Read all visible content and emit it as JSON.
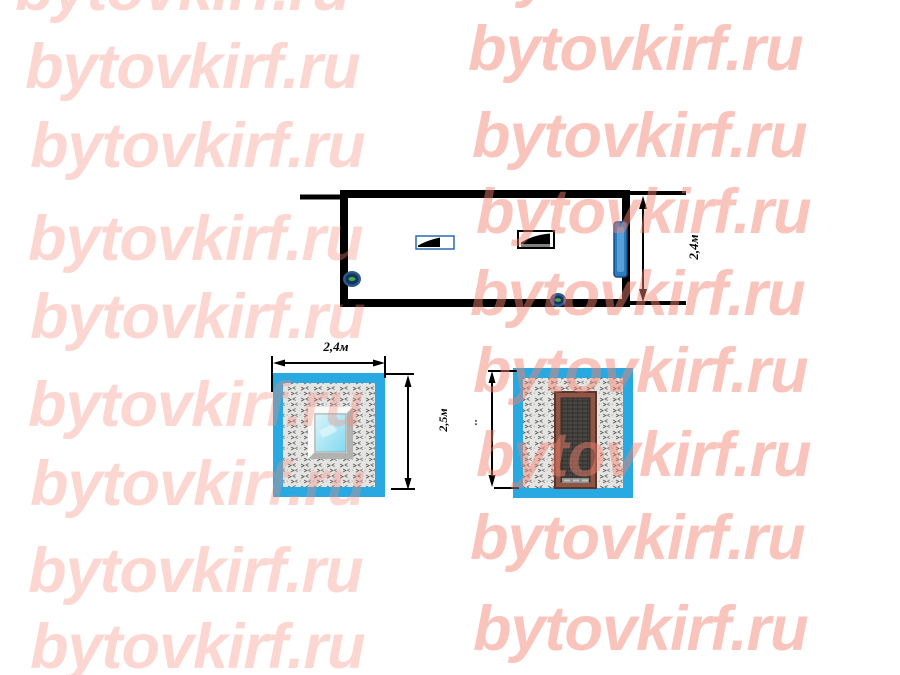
{
  "watermark": {
    "text": "bytovkirf.ru"
  },
  "drawing": {
    "plan": {
      "width_label": "2,4м"
    },
    "front_elevation": {
      "width_label": "2,4м",
      "height_label": "2,5м"
    },
    "door_elevation": {
      "height_label": ":"
    }
  },
  "colors": {
    "watermark_left": "rgba(245,140,125,0.35)",
    "watermark_right": "rgba(242,130,110,0.47)",
    "frame_cyan": "#29a9e1",
    "glass_cyan": "#8ad9f0",
    "plan_door_blue": "#2e7cc0",
    "door_brown": "#8f5546",
    "line": "#000000",
    "texture_bg": "#e4e4e2"
  }
}
